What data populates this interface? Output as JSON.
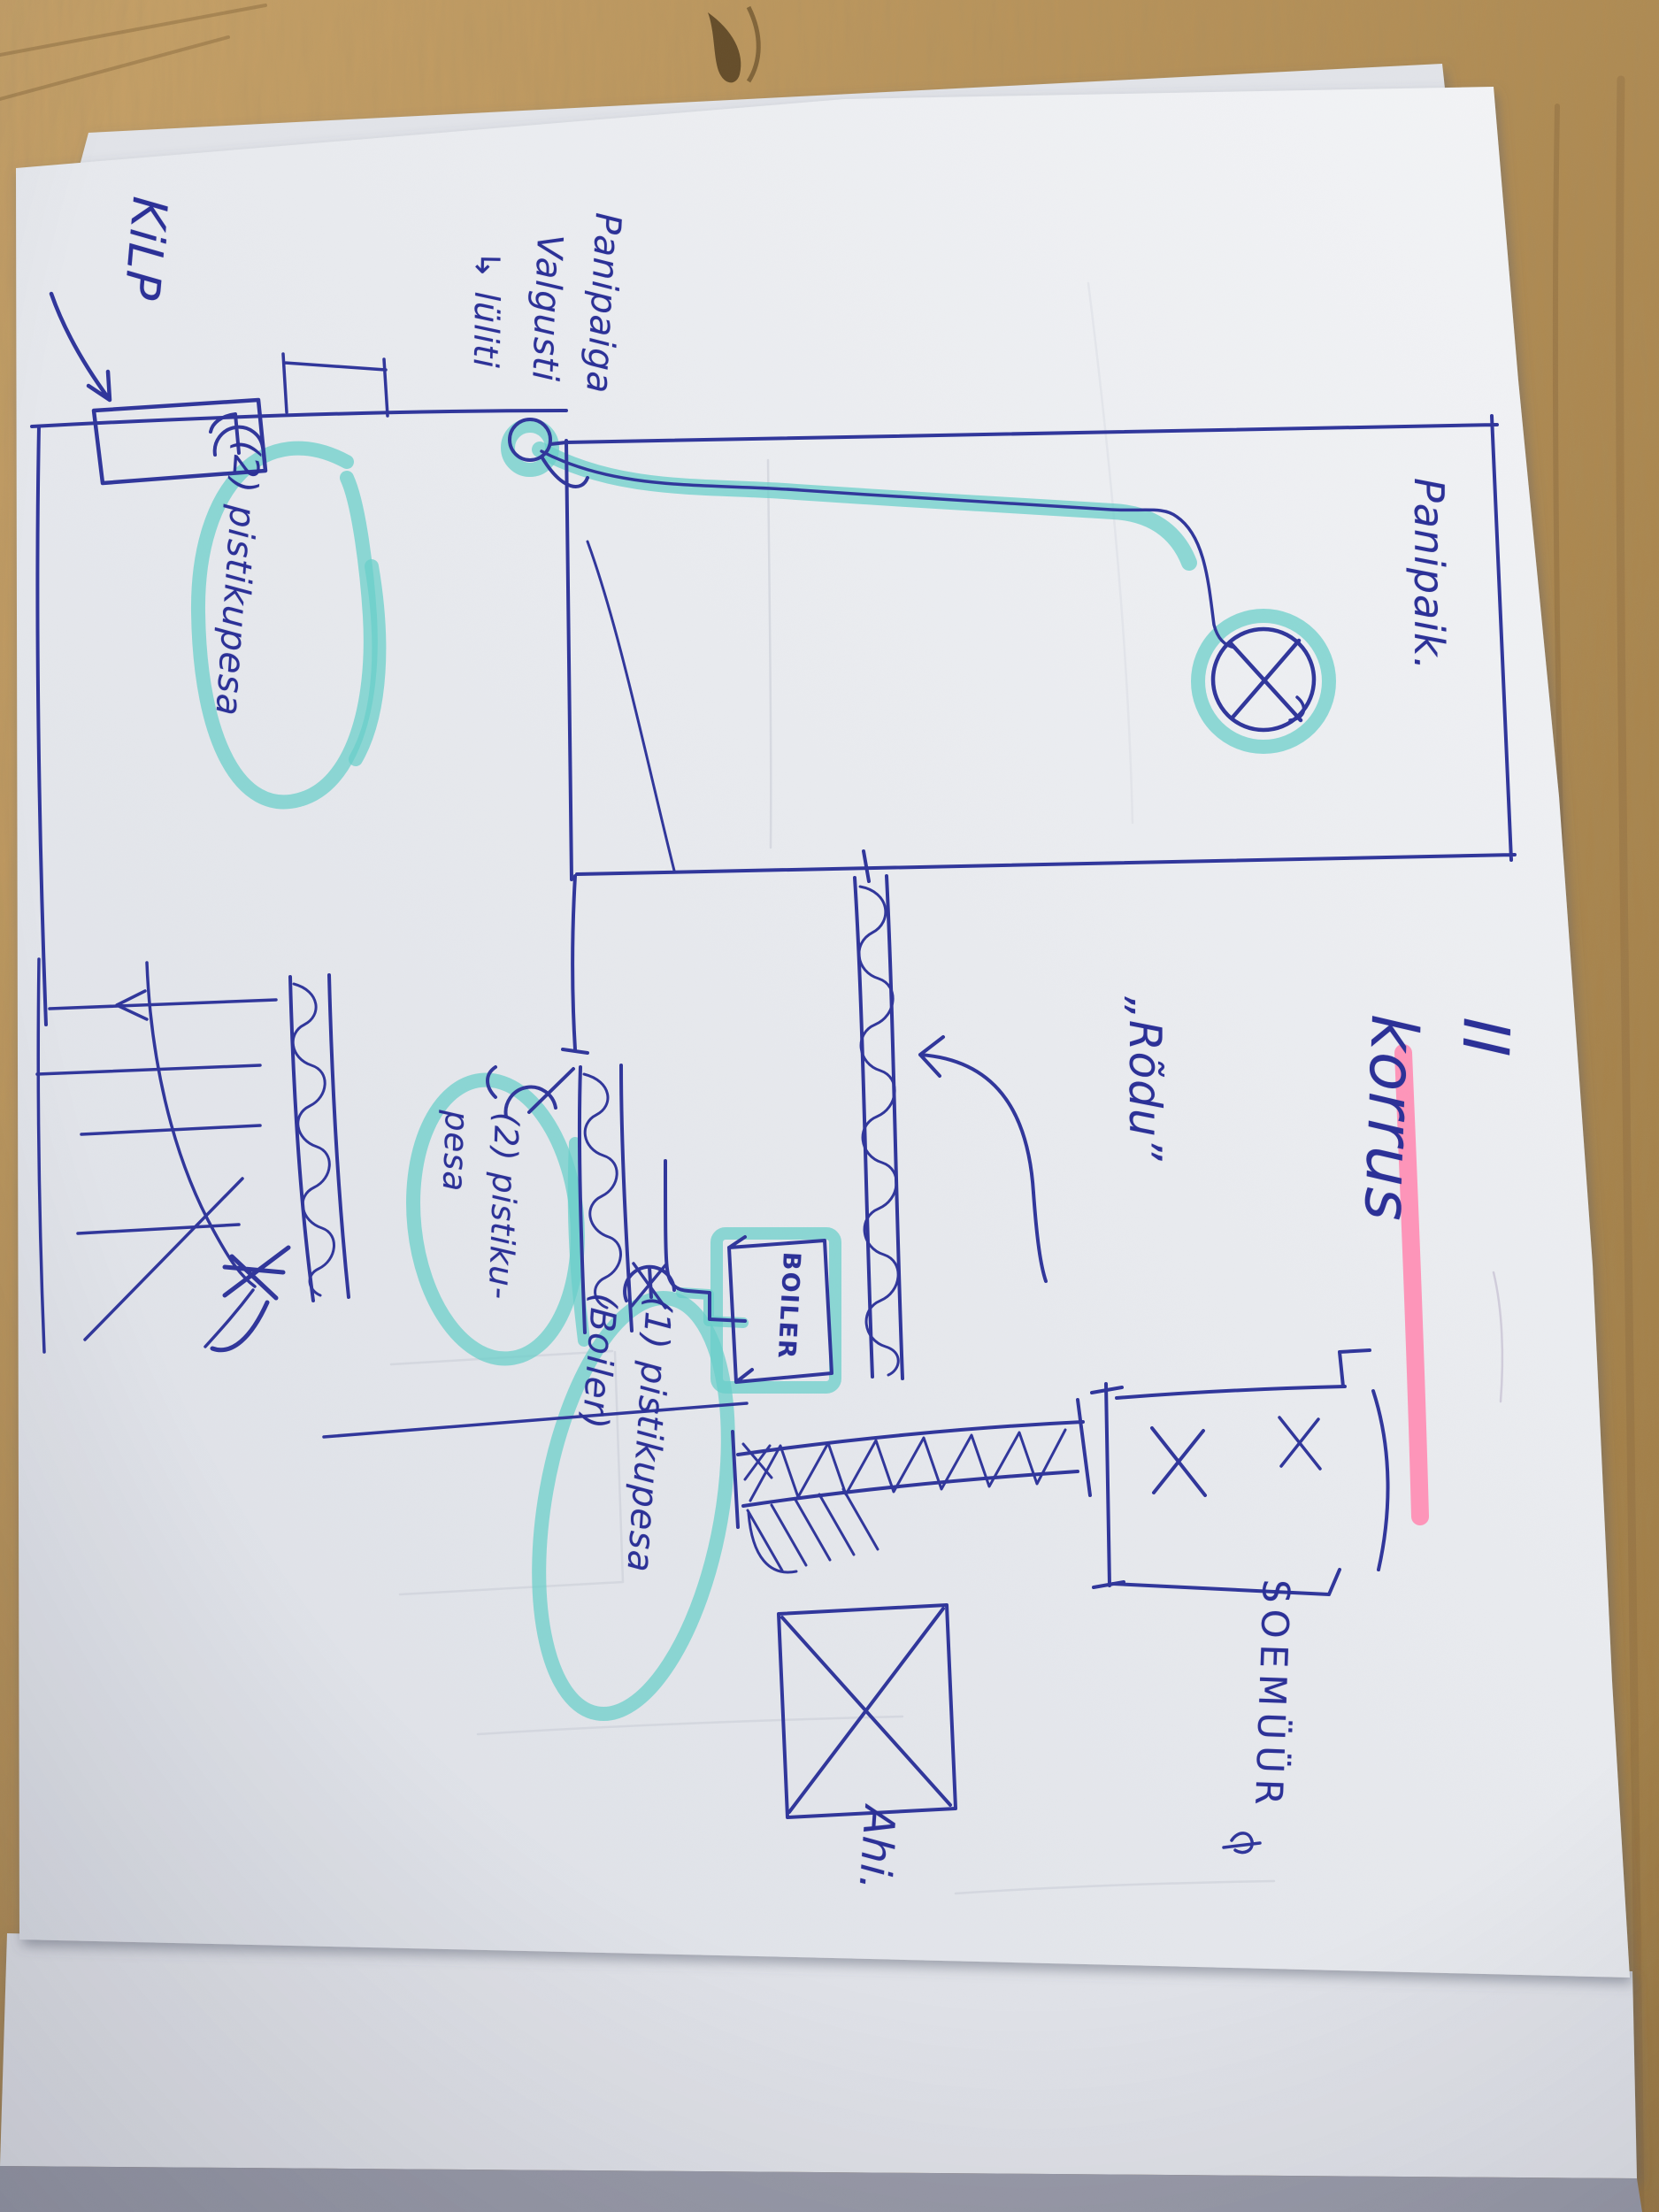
{
  "labels": {
    "title": "II korrus",
    "room": "Panipaik.",
    "panel": "KiLP",
    "storage_light_line1": "Panipaiga",
    "storage_light_line2": "Valgusti",
    "storage_light_line3": "↳ lüliti",
    "outlet_storage": "(2) pistikupesa",
    "outlet_room": "(2) pistiku-\npesa",
    "outlet_boiler": "(1) pistikupesa\n(Boiler)",
    "boiler": "BOILER",
    "balcony": "„Rõdu”",
    "warm_wall": "SOEMÜÜR",
    "stove": "Ahi."
  },
  "colors": {
    "ink": "#2c3197",
    "highlighter_cyan": "#68cec9",
    "highlighter_pink": "#ff8cb2",
    "paper": "#eceef2",
    "wood": "#b18a54"
  }
}
